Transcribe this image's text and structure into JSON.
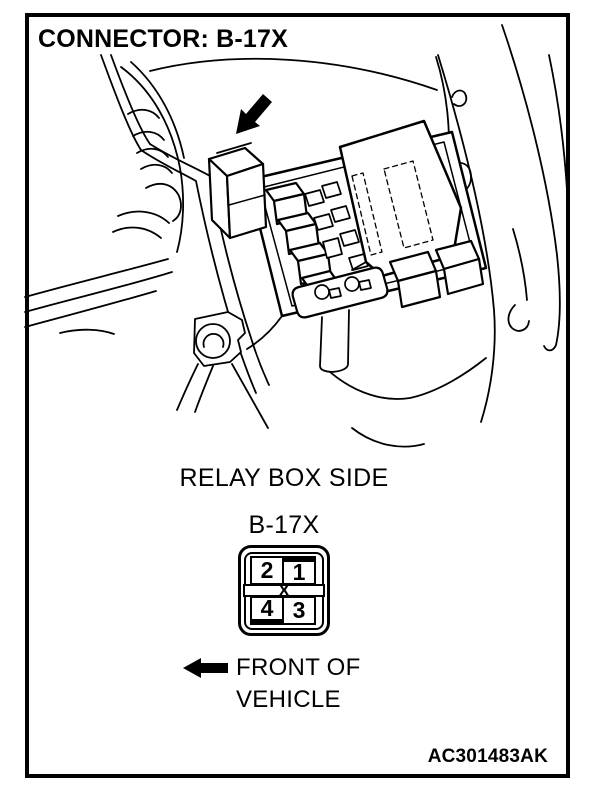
{
  "figure": {
    "title": "CONNECTOR: B-17X",
    "code": "AC301483AK"
  },
  "diagram": {
    "view_label": "RELAY BOX SIDE",
    "connector_label": "B-17X",
    "pins": {
      "top_left": "2",
      "top_right": "1",
      "bottom_left": "4",
      "bottom_right": "3",
      "key": "X"
    },
    "direction": {
      "line1": "FRONT OF",
      "line2": "VEHICLE"
    }
  },
  "icons": {
    "callout_arrow": "arrow-down-left",
    "front_arrow": "arrow-left"
  },
  "colors": {
    "ink": "#000000",
    "paper": "#ffffff"
  }
}
